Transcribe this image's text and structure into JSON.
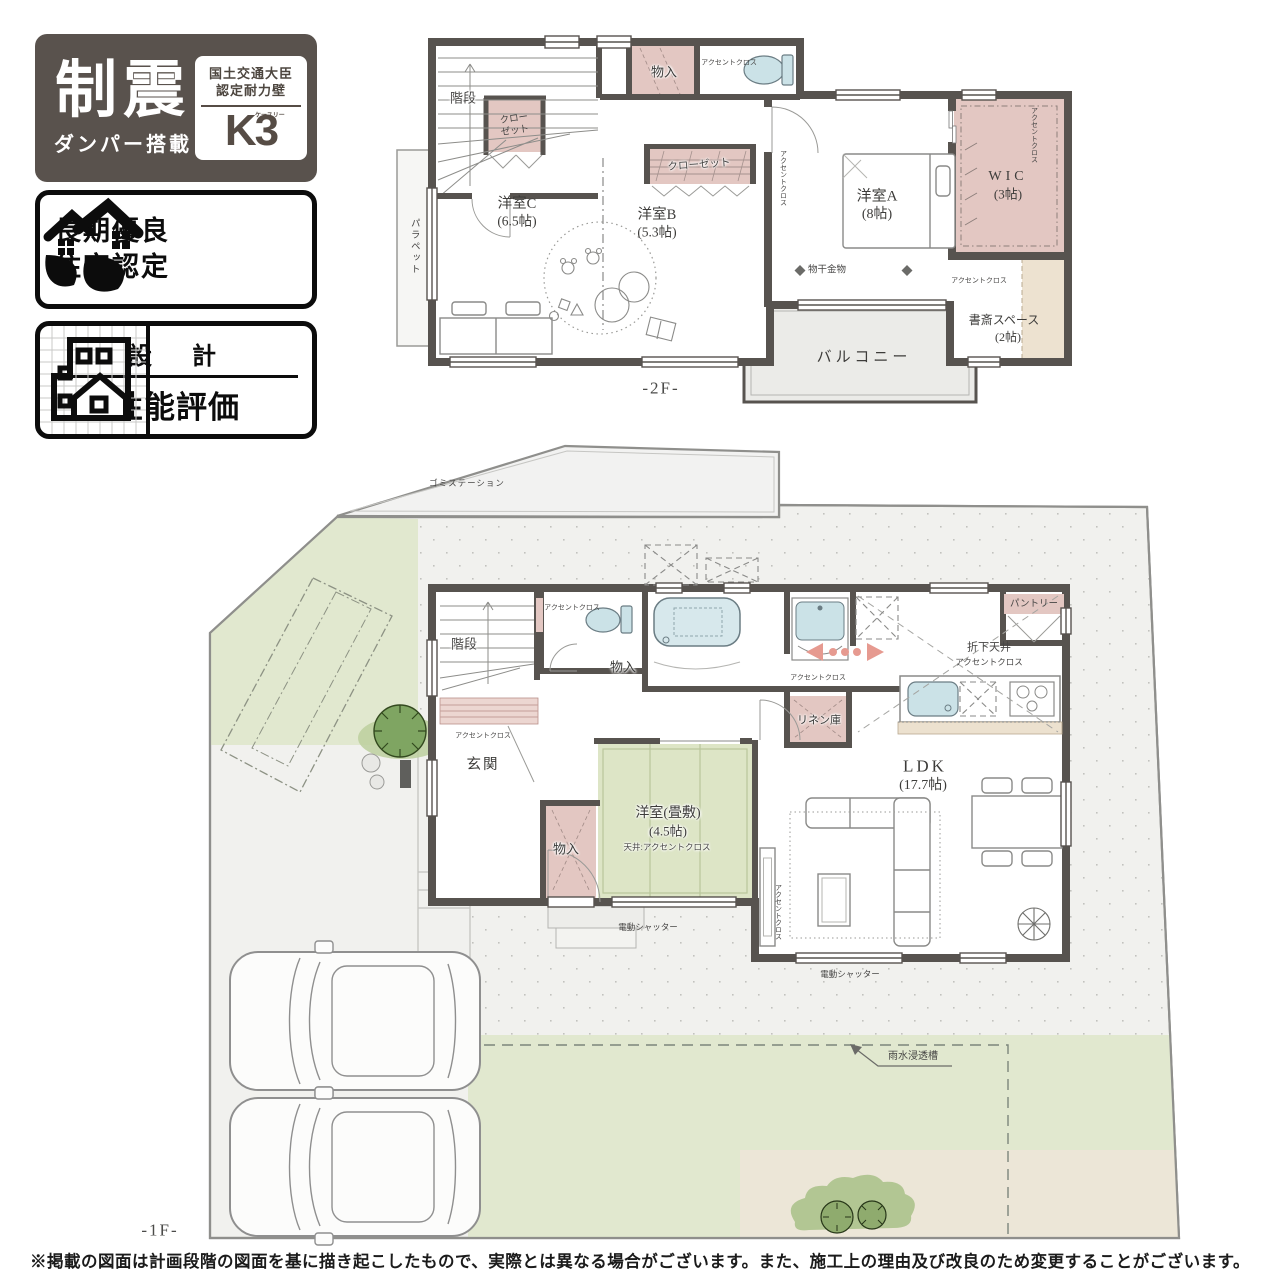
{
  "badges": {
    "seismic": {
      "title": "制震",
      "subtitle": "ダンパー搭載",
      "cert_line1": "国土交通大臣",
      "cert_line2": "認定耐力壁",
      "k_mark": "K3",
      "k_ruby": "ケースリー"
    },
    "choki": {
      "line1": "長期優良",
      "line2": "住宅認定"
    },
    "sekkei": {
      "top": "設　計",
      "bottom": "性能評価"
    }
  },
  "f2": {
    "floor": "-2F-",
    "kaidan": "階段",
    "cl1": "クロー",
    "cl2": "ゼット",
    "monoiri": "物入",
    "ac_toilet": "アクセントクロス",
    "cl_b": "クローゼット",
    "yc1": "洋室C",
    "yc2": "(6.5帖)",
    "yb1": "洋室B",
    "yb2": "(5.3帖)",
    "ya1": "洋室A",
    "ya2": "(8帖)",
    "wic1": "WIC",
    "wic2": "(3帖)",
    "ac_wic": "アクセントクロス",
    "monohoshi": "物干金物",
    "ac_shosai": "アクセントクロス",
    "shosai1": "書斎スペース",
    "shosai2": "(2帖)",
    "balcony": "バルコニー",
    "parapet": "パラペット",
    "ac_hall": "アクセントクロス"
  },
  "f1": {
    "floor": "-1F-",
    "kaidan": "階段",
    "ac_toilet": "アクセントクロス",
    "monoiri_a": "物入",
    "rinen": "リネン庫",
    "ac_rinen": "アクセントクロス",
    "orisage1": "折下天井",
    "orisage2": "アクセントクロス",
    "pantry": "パントリー",
    "ldk1": "LDK",
    "ldk2": "(17.7帖)",
    "wa1": "洋室(畳敷)",
    "wa2": "(4.5帖)",
    "wa3": "天井:アクセントクロス",
    "monoiri_b": "物入",
    "genkan": "玄関",
    "ac_genkan": "アクセントクロス",
    "shutter1": "電動シャッター",
    "shutter2": "電動シャッター",
    "ac_ldk": "アクセントクロス"
  },
  "site": {
    "gomi": "ゴミステーション",
    "usui": "雨水浸透槽"
  },
  "footer": {
    "disclaimer": "※掲載の図面は計画段階の図面を基に描き起こしたもので、実際とは異なる場合がございます。また、施工上の理由及び改良のため変更することがございます。"
  },
  "colors": {
    "wall": "#57534f",
    "accent_pink": "#e3c7c2",
    "tatami_green": "#dde5c6",
    "site_green": "#e1e8cf",
    "beige": "#ece6d7",
    "fixture_blue": "#cbe2e7",
    "arrow_pink": "#e69a90",
    "badge_dark": "#59524d"
  }
}
